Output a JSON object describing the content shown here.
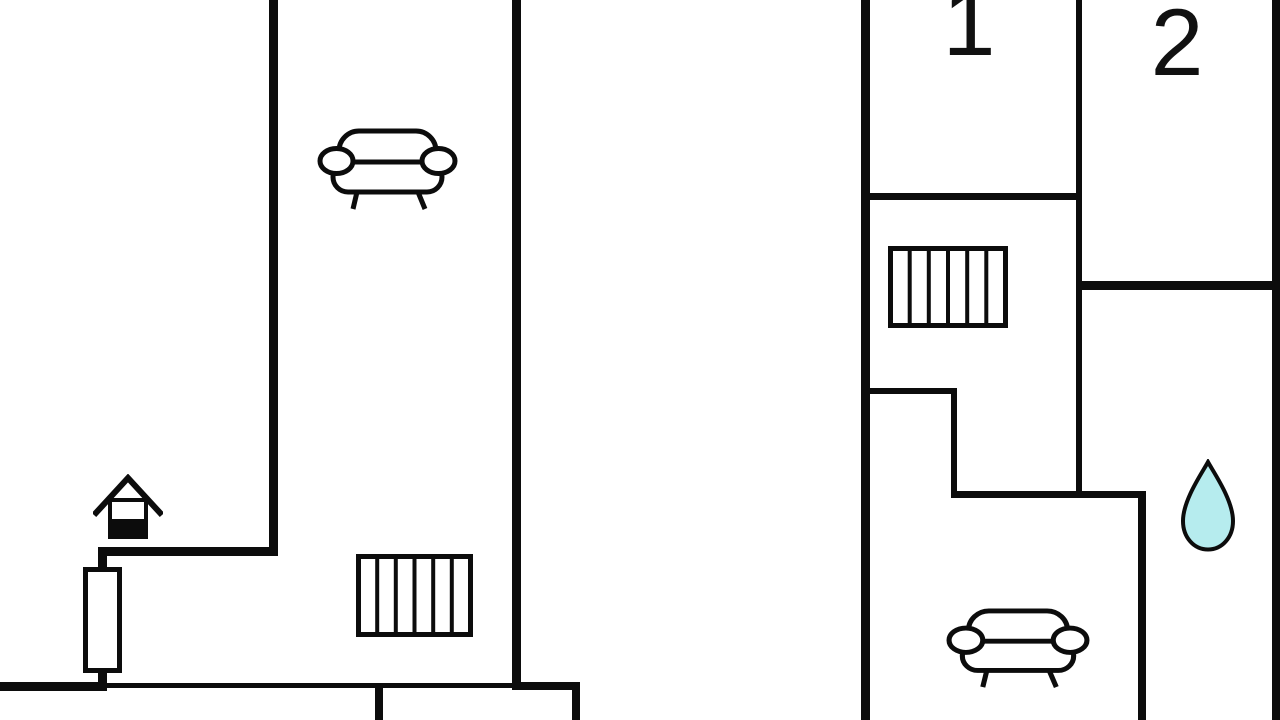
{
  "floor_plan": {
    "background": "#ffffff",
    "line_color": "#0c0c0c",
    "left_unit": {
      "icons": [
        "sofa-icon",
        "stairs-icon",
        "stove-house-icon",
        "window-element"
      ]
    },
    "right_unit": {
      "room_labels": [
        {
          "id": "room-1",
          "text": "1"
        },
        {
          "id": "room-2",
          "text": "2"
        }
      ],
      "icons": [
        "stairs-icon",
        "water-drop-icon",
        "sofa-icon"
      ],
      "water_drop_fill": "#b6ecee"
    }
  }
}
